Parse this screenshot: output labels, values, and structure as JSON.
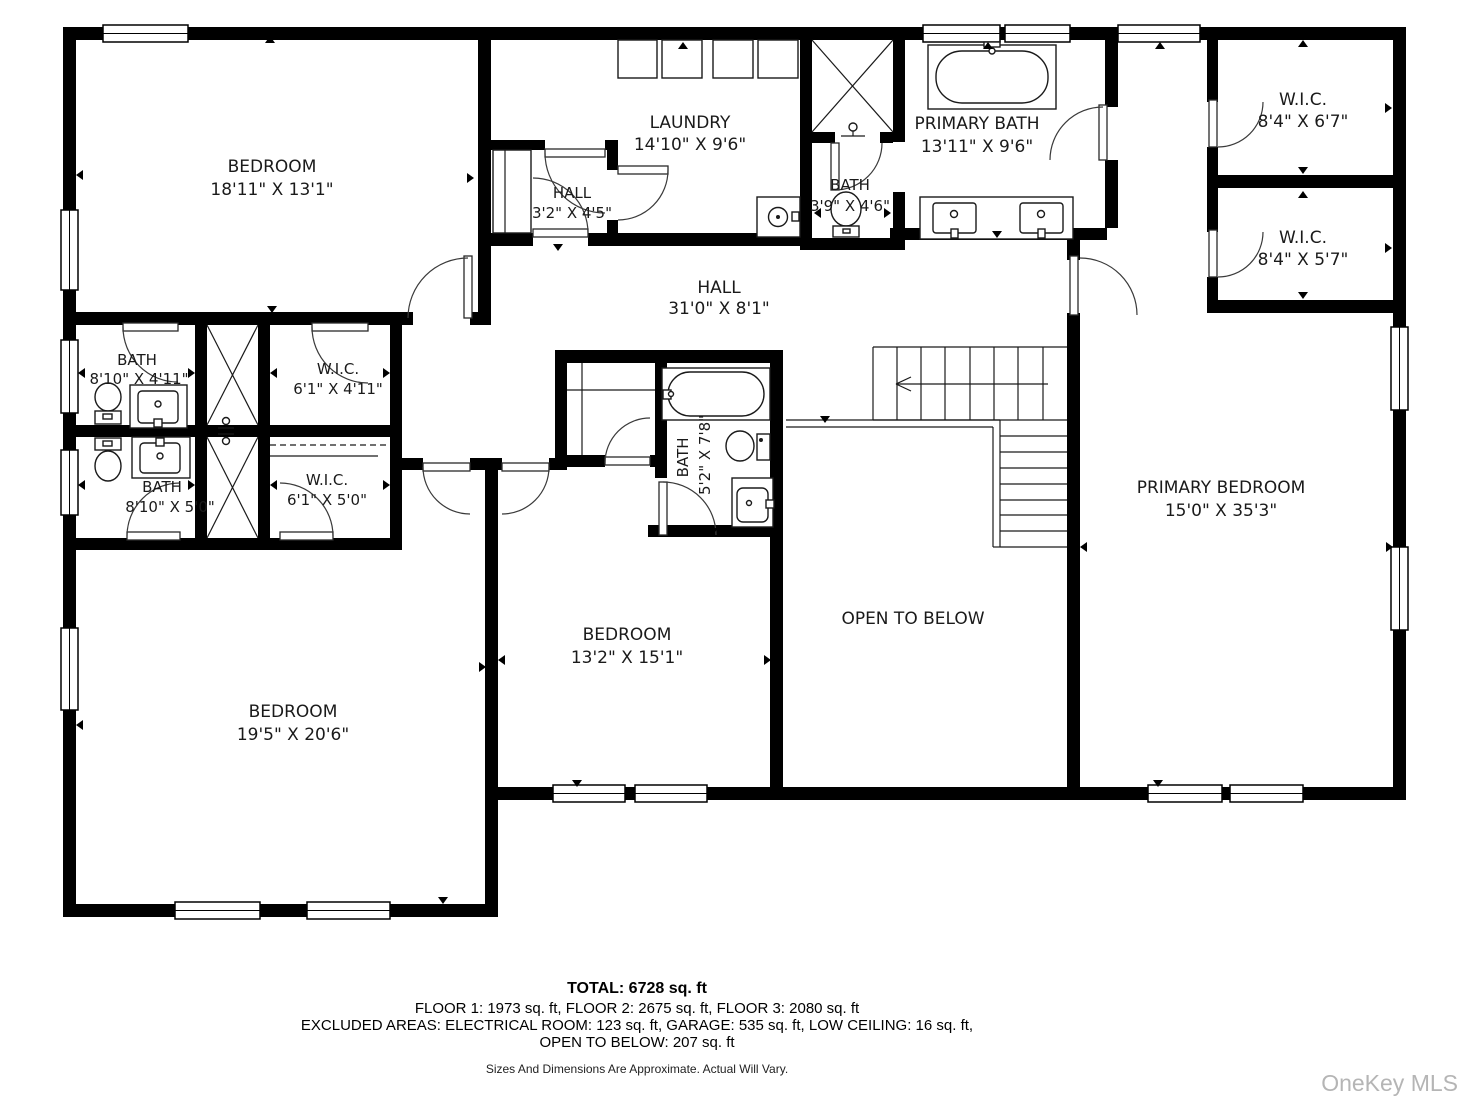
{
  "rooms": {
    "bedroom_tl": {
      "name": "BEDROOM",
      "dims": "18'11\" X 13'1\""
    },
    "laundry": {
      "name": "LAUNDRY",
      "dims": "14'10\" X 9'6\""
    },
    "hall_small": {
      "name": "HALL",
      "dims": "3'2\" X 4'5\""
    },
    "bath_small": {
      "name": "BATH",
      "dims": "3'9\" X 4'6\""
    },
    "primary_bath": {
      "name": "PRIMARY BATH",
      "dims": "13'11\" X 9'6\""
    },
    "wic_top": {
      "name": "W.I.C.",
      "dims": "8'4\" X 6'7\""
    },
    "wic_bottom": {
      "name": "W.I.C.",
      "dims": "8'4\" X 5'7\""
    },
    "hall_main": {
      "name": "HALL",
      "dims": "31'0\" X 8'1\""
    },
    "bath_left_upper": {
      "name": "BATH",
      "dims": "8'10\" X 4'11\""
    },
    "wic_left_upper": {
      "name": "W.I.C.",
      "dims": "6'1\" X 4'11\""
    },
    "bath_left_lower": {
      "name": "BATH",
      "dims": "8'10\" X 5'0\""
    },
    "wic_left_lower": {
      "name": "W.I.C.",
      "dims": "6'1\" X 5'0\""
    },
    "bath_middle": {
      "name": "BATH",
      "dims": "5'2\" X 7'8\""
    },
    "bedroom_middle": {
      "name": "BEDROOM",
      "dims": "13'2\" X 15'1\""
    },
    "open_to_below": {
      "name": "OPEN TO BELOW",
      "dims": ""
    },
    "bedroom_bl": {
      "name": "BEDROOM",
      "dims": "19'5\" X 20'6\""
    },
    "primary_bedroom": {
      "name": "PRIMARY BEDROOM",
      "dims": "15'0\" X 35'3\""
    }
  },
  "footer": {
    "total": "TOTAL: 6728 sq. ft",
    "line1": "FLOOR 1: 1973 sq. ft, FLOOR 2: 2675 sq. ft, FLOOR 3: 2080 sq. ft",
    "line2": "EXCLUDED AREAS: ELECTRICAL ROOM: 123 sq. ft, GARAGE: 535 sq. ft, LOW CEILING: 16 sq. ft,",
    "line3": "OPEN TO BELOW: 207 sq. ft",
    "disclaimer": "Sizes And Dimensions Are Approximate. Actual Will Vary."
  },
  "watermark": "OneKey MLS",
  "colors": {
    "wall": "#000000",
    "background": "#ffffff",
    "watermark": "#b5b5b5"
  }
}
